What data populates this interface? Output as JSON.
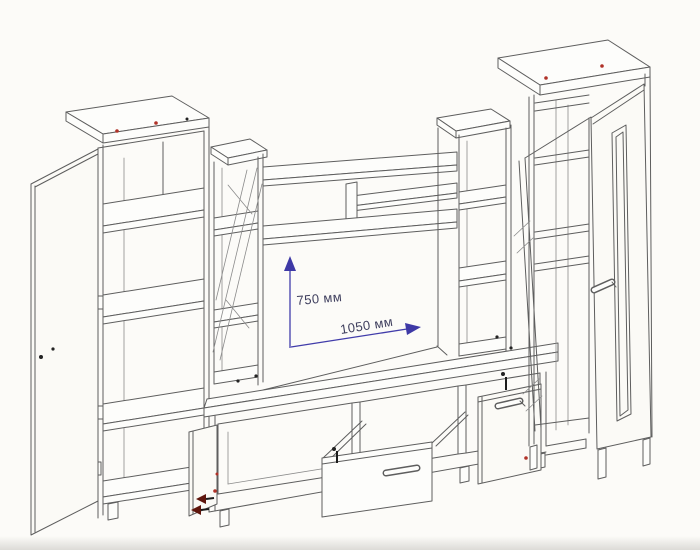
{
  "diagram": {
    "kind": "wall-unit-furniture-assembly-drawing",
    "dimension_labels": {
      "niche_height": "750 мм",
      "niche_width": "1050 мм"
    },
    "colors": {
      "background": "#fcfbf8",
      "line": "#5e5e5e",
      "dimension_blue": "#3e39a6",
      "dimension_text": "#3f3f5e",
      "marker_red": "#b03228",
      "marker_dark": "#1c1c1c"
    },
    "components": [
      "left-tall-cabinet-with-open-door",
      "left-display-column-with-glass-door",
      "wall-shelves-over-tv-niche",
      "tv-niche",
      "right-display-column",
      "right-wardrobe-with-glass-strip-door",
      "tv-stand-base",
      "tv-stand-open-left-door",
      "tv-stand-pulled-out-drawer",
      "tv-stand-open-right-door"
    ]
  }
}
